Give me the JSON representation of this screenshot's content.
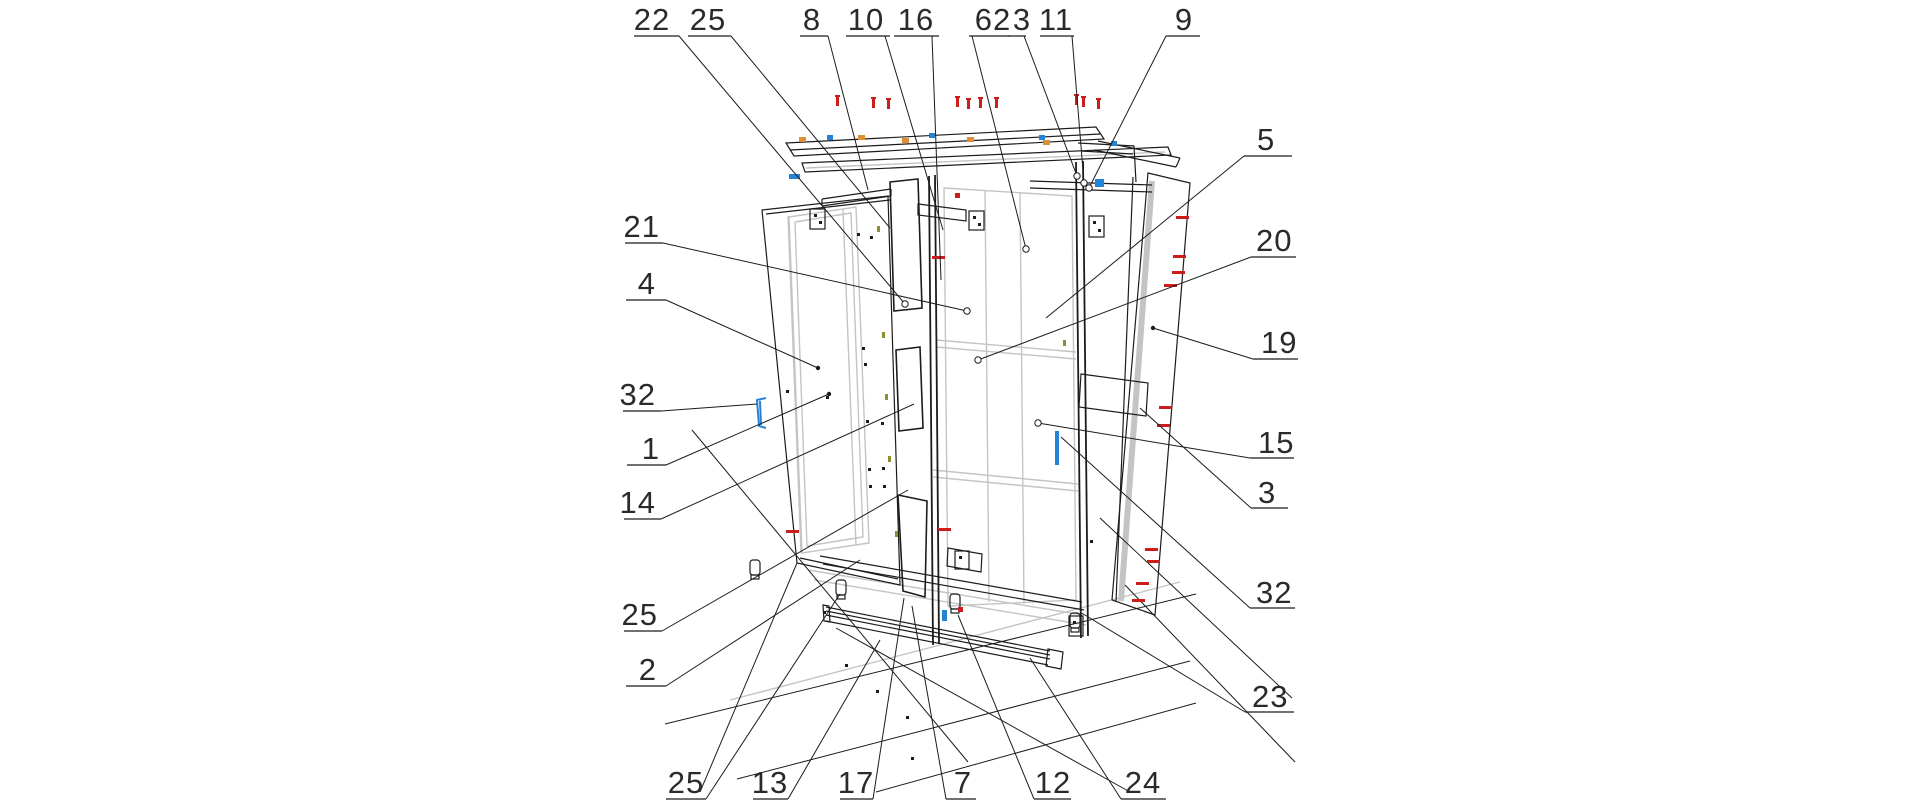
{
  "figure": {
    "kind": "exploded-assembly-technical-drawing",
    "subject": "wardrobe-cabinet-exploded-view",
    "background": "#ffffff"
  },
  "colors": {
    "line_dark": "#1c1c1c",
    "line_secondary": "#c4c4c4",
    "screw_red": "#cc1d1d",
    "fitting_blue": "#2583d5",
    "fitting_orange": "#dd8f35",
    "fitting_olive": "#8f8f2f",
    "label_text": "#2a2a2a"
  },
  "callouts": [
    {
      "label": "22",
      "side": "top",
      "tx": 652,
      "ty": 30,
      "anchor": "middle",
      "ux1": 634,
      "ux2": 679,
      "uy": 36,
      "sx": 679,
      "sy": 36,
      "ex": 905,
      "ey": 304,
      "end": "circle"
    },
    {
      "label": "25",
      "side": "top",
      "tx": 708,
      "ty": 30,
      "anchor": "middle",
      "ux1": 688,
      "ux2": 731,
      "uy": 36,
      "sx": 731,
      "sy": 36,
      "ex": 890,
      "ey": 228,
      "end": "none"
    },
    {
      "label": "8",
      "side": "top",
      "tx": 812,
      "ty": 30,
      "anchor": "middle",
      "ux1": 800,
      "ux2": 828,
      "uy": 36,
      "sx": 828,
      "sy": 36,
      "ex": 868,
      "ey": 190,
      "end": "none"
    },
    {
      "label": "10",
      "side": "top",
      "tx": 866,
      "ty": 30,
      "anchor": "middle",
      "ux1": 846,
      "ux2": 890,
      "uy": 36,
      "sx": 885,
      "sy": 36,
      "ex": 943,
      "ey": 230,
      "end": "none"
    },
    {
      "label": "16",
      "side": "top",
      "tx": 916,
      "ty": 30,
      "anchor": "middle",
      "ux1": 894,
      "ux2": 939,
      "uy": 36,
      "sx": 932,
      "sy": 36,
      "ex": 941,
      "ey": 280,
      "end": "none"
    },
    {
      "label": "62",
      "side": "top",
      "tx": 993,
      "ty": 30,
      "anchor": "middle",
      "ux1": 969,
      "ux2": 1010,
      "uy": 36,
      "sx": 972,
      "sy": 36,
      "ex": 1026,
      "ey": 249,
      "end": "circle"
    },
    {
      "label": "3",
      "side": "top",
      "tx": 1022,
      "ty": 30,
      "anchor": "middle",
      "ux1": 1008,
      "ux2": 1026,
      "uy": 36,
      "sx": 1024,
      "sy": 36,
      "ex": 1077,
      "ey": 176,
      "end": "circle"
    },
    {
      "label": "11",
      "side": "top",
      "tx": 1056,
      "ty": 30,
      "anchor": "middle",
      "ux1": 1040,
      "ux2": 1074,
      "uy": 36,
      "sx": 1072,
      "sy": 36,
      "ex": 1084,
      "ey": 183,
      "end": "circle"
    },
    {
      "label": "9",
      "side": "top",
      "tx": 1184,
      "ty": 30,
      "anchor": "middle",
      "ux1": 1166,
      "ux2": 1200,
      "uy": 36,
      "sx": 1166,
      "sy": 36,
      "ex": 1089,
      "ey": 188,
      "end": "circle"
    },
    {
      "label": "5",
      "side": "right",
      "tx": 1257,
      "ty": 150,
      "anchor": "start",
      "ux1": 1244,
      "ux2": 1292,
      "uy": 156,
      "sx": 1244,
      "sy": 156,
      "ex": 1046,
      "ey": 318,
      "end": "none"
    },
    {
      "label": "20",
      "side": "right",
      "tx": 1256,
      "ty": 251,
      "anchor": "start",
      "ux1": 1251,
      "ux2": 1296,
      "uy": 257,
      "sx": 1251,
      "sy": 257,
      "ex": 978,
      "ey": 360,
      "end": "circle"
    },
    {
      "label": "19",
      "side": "right",
      "tx": 1261,
      "ty": 353,
      "anchor": "start",
      "ux1": 1253,
      "ux2": 1298,
      "uy": 359,
      "sx": 1253,
      "sy": 359,
      "ex": 1153,
      "ey": 328,
      "end": "dot"
    },
    {
      "label": "15",
      "side": "right",
      "tx": 1258,
      "ty": 453,
      "anchor": "start",
      "ux1": 1250,
      "ux2": 1294,
      "uy": 458,
      "sx": 1250,
      "sy": 458,
      "ex": 1038,
      "ey": 423,
      "end": "circle"
    },
    {
      "label": "3",
      "side": "right",
      "tx": 1258,
      "ty": 503,
      "anchor": "start",
      "ux1": 1251,
      "ux2": 1288,
      "uy": 508,
      "sx": 1251,
      "sy": 508,
      "ex": 1140,
      "ey": 408,
      "end": "none"
    },
    {
      "label": "32",
      "side": "right",
      "tx": 1256,
      "ty": 603,
      "anchor": "start",
      "ux1": 1250,
      "ux2": 1295,
      "uy": 608,
      "sx": 1250,
      "sy": 608,
      "ex": 1061,
      "ey": 437,
      "end": "none"
    },
    {
      "label": "23",
      "side": "right",
      "tx": 1252,
      "ty": 707,
      "anchor": "start",
      "ux1": 1245,
      "ux2": 1294,
      "uy": 712,
      "sx": 1245,
      "sy": 712,
      "ex": 1080,
      "ey": 612,
      "end": "none"
    },
    {
      "label": "25",
      "side": "bottom",
      "tx": 686,
      "ty": 793,
      "anchor": "middle",
      "ux1": 666,
      "ux2": 706,
      "uy": 799,
      "sx": 706,
      "sy": 799,
      "ex": 840,
      "ey": 594,
      "end": "none"
    },
    {
      "label": "13",
      "side": "bottom",
      "tx": 770,
      "ty": 793,
      "anchor": "middle",
      "ux1": 753,
      "ux2": 788,
      "uy": 799,
      "sx": 788,
      "sy": 799,
      "ex": 880,
      "ey": 640,
      "end": "none"
    },
    {
      "label": "17",
      "side": "bottom",
      "tx": 856,
      "ty": 793,
      "anchor": "middle",
      "ux1": 840,
      "ux2": 873,
      "uy": 799,
      "sx": 873,
      "sy": 799,
      "ex": 904,
      "ey": 598,
      "end": "none"
    },
    {
      "label": "7",
      "side": "bottom",
      "tx": 963,
      "ty": 793,
      "anchor": "middle",
      "ux1": 946,
      "ux2": 976,
      "uy": 799,
      "sx": 946,
      "sy": 799,
      "ex": 912,
      "ey": 606,
      "end": "none"
    },
    {
      "label": "12",
      "side": "bottom",
      "tx": 1053,
      "ty": 793,
      "anchor": "middle",
      "ux1": 1034,
      "ux2": 1071,
      "uy": 799,
      "sx": 1034,
      "sy": 799,
      "ex": 958,
      "ey": 615,
      "end": "none"
    },
    {
      "label": "24",
      "side": "bottom",
      "tx": 1143,
      "ty": 793,
      "anchor": "middle",
      "ux1": 1121,
      "ux2": 1166,
      "uy": 799,
      "sx": 1121,
      "sy": 799,
      "ex": 1030,
      "ey": 658,
      "end": "none"
    },
    {
      "label": "21",
      "side": "left",
      "tx": 660,
      "ty": 237,
      "anchor": "end",
      "ux1": 625,
      "ux2": 663,
      "uy": 243,
      "sx": 663,
      "sy": 243,
      "ex": 967,
      "ey": 311,
      "end": "circle"
    },
    {
      "label": "4",
      "side": "left",
      "tx": 656,
      "ty": 294,
      "anchor": "end",
      "ux1": 626,
      "ux2": 666,
      "uy": 300,
      "sx": 666,
      "sy": 300,
      "ex": 818,
      "ey": 368,
      "end": "dot"
    },
    {
      "label": "32",
      "side": "left",
      "tx": 656,
      "ty": 405,
      "anchor": "end",
      "ux1": 623,
      "ux2": 661,
      "uy": 411,
      "sx": 661,
      "sy": 411,
      "ex": 757,
      "ey": 404,
      "end": "none"
    },
    {
      "label": "1",
      "side": "left",
      "tx": 660,
      "ty": 459,
      "anchor": "end",
      "ux1": 627,
      "ux2": 666,
      "uy": 465,
      "sx": 666,
      "sy": 465,
      "ex": 829,
      "ey": 394,
      "end": "dot"
    },
    {
      "label": "14",
      "side": "left",
      "tx": 656,
      "ty": 513,
      "anchor": "end",
      "ux1": 624,
      "ux2": 661,
      "uy": 519,
      "sx": 661,
      "sy": 519,
      "ex": 914,
      "ey": 404,
      "end": "none"
    },
    {
      "label": "25",
      "side": "left",
      "tx": 658,
      "ty": 625,
      "anchor": "end",
      "ux1": 624,
      "ux2": 662,
      "uy": 631,
      "sx": 662,
      "sy": 631,
      "ex": 908,
      "ey": 490,
      "end": "none"
    },
    {
      "label": "2",
      "side": "left",
      "tx": 657,
      "ty": 680,
      "anchor": "end",
      "ux1": 626,
      "ux2": 666,
      "uy": 686,
      "sx": 666,
      "sy": 686,
      "ex": 860,
      "ey": 560,
      "end": "none"
    }
  ],
  "hardware": {
    "red_screws_vertical": [
      {
        "x": 836,
        "y": 95
      },
      {
        "x": 872,
        "y": 97
      },
      {
        "x": 887,
        "y": 98
      },
      {
        "x": 956,
        "y": 96
      },
      {
        "x": 967,
        "y": 98
      },
      {
        "x": 979,
        "y": 97
      },
      {
        "x": 995,
        "y": 97
      },
      {
        "x": 1075,
        "y": 94
      },
      {
        "x": 1082,
        "y": 96
      },
      {
        "x": 1097,
        "y": 98
      }
    ],
    "red_screws_horizontal": [
      {
        "x": 1176,
        "y": 216
      },
      {
        "x": 1173,
        "y": 255
      },
      {
        "x": 1172,
        "y": 271
      },
      {
        "x": 1164,
        "y": 284
      },
      {
        "x": 1159,
        "y": 406
      },
      {
        "x": 1157,
        "y": 424
      },
      {
        "x": 1145,
        "y": 548
      },
      {
        "x": 1147,
        "y": 560
      },
      {
        "x": 1136,
        "y": 582
      },
      {
        "x": 1132,
        "y": 599
      },
      {
        "x": 932,
        "y": 256
      },
      {
        "x": 786,
        "y": 530
      },
      {
        "x": 938,
        "y": 528
      }
    ],
    "red_squares": [
      {
        "x": 955,
        "y": 193
      },
      {
        "x": 958,
        "y": 607
      }
    ],
    "blue_fittings": [
      {
        "kind": "hinge-bracket",
        "x": 757,
        "y": 398,
        "w": 9,
        "h": 30
      },
      {
        "kind": "bar",
        "x": 1055,
        "y": 431,
        "w": 4,
        "h": 34
      },
      {
        "kind": "dash",
        "x": 789,
        "y": 174,
        "w": 11,
        "h": 5
      },
      {
        "kind": "square",
        "x": 1095,
        "y": 179,
        "w": 9,
        "h": 8
      },
      {
        "kind": "bar",
        "x": 942,
        "y": 610,
        "w": 5,
        "h": 11
      }
    ],
    "blue_dots": [
      {
        "x": 827,
        "y": 135
      },
      {
        "x": 929,
        "y": 133
      },
      {
        "x": 1039,
        "y": 135
      },
      {
        "x": 1111,
        "y": 141
      }
    ],
    "orange_dots": [
      {
        "x": 799,
        "y": 137
      },
      {
        "x": 858,
        "y": 135
      },
      {
        "x": 902,
        "y": 138
      },
      {
        "x": 967,
        "y": 137
      },
      {
        "x": 1043,
        "y": 140
      }
    ],
    "olive_ticks": [
      {
        "x": 877,
        "y": 226
      },
      {
        "x": 882,
        "y": 332
      },
      {
        "x": 885,
        "y": 394
      },
      {
        "x": 888,
        "y": 456
      },
      {
        "x": 895,
        "y": 531
      },
      {
        "x": 1063,
        "y": 340
      }
    ],
    "hole_dots": [
      {
        "x": 857,
        "y": 233
      },
      {
        "x": 870,
        "y": 236
      },
      {
        "x": 862,
        "y": 347
      },
      {
        "x": 864,
        "y": 363
      },
      {
        "x": 866,
        "y": 420
      },
      {
        "x": 881,
        "y": 422
      },
      {
        "x": 868,
        "y": 468
      },
      {
        "x": 882,
        "y": 467
      },
      {
        "x": 869,
        "y": 485
      },
      {
        "x": 883,
        "y": 485
      },
      {
        "x": 786,
        "y": 390
      },
      {
        "x": 826,
        "y": 396
      },
      {
        "x": 845,
        "y": 664
      },
      {
        "x": 876,
        "y": 690
      },
      {
        "x": 823,
        "y": 611
      },
      {
        "x": 906,
        "y": 716
      },
      {
        "x": 1090,
        "y": 540
      },
      {
        "x": 911,
        "y": 757
      }
    ]
  }
}
